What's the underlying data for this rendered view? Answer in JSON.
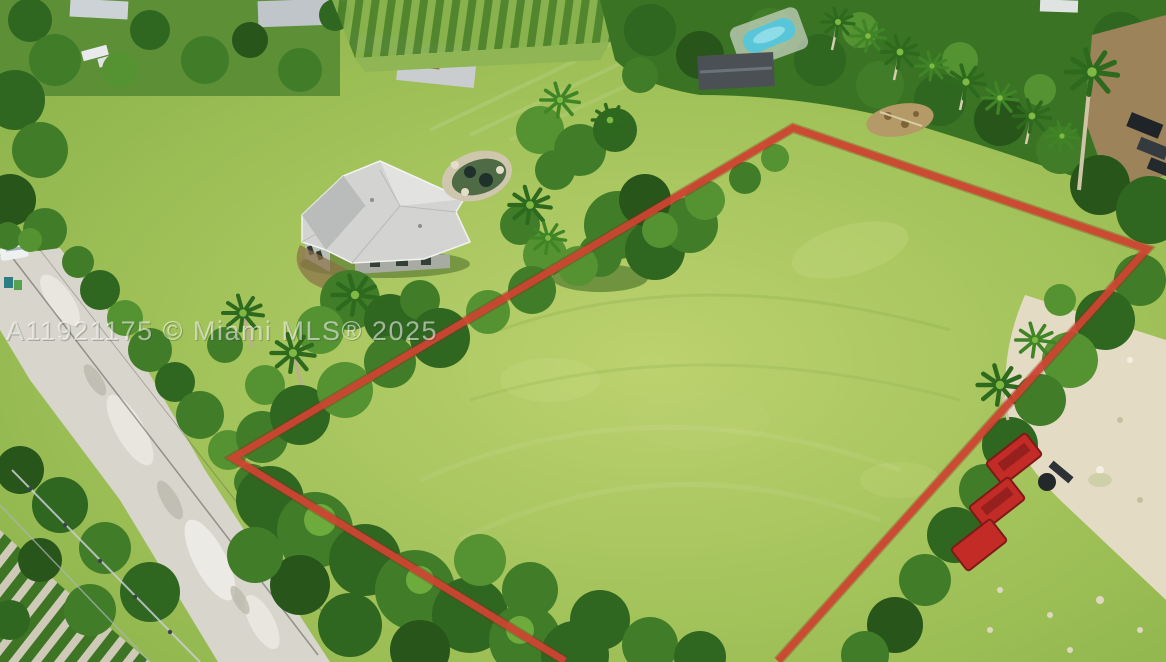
{
  "image": {
    "kind": "aerial-drone-photo",
    "description": "Aerial view of a vacant grass lot outlined in red beside a single-family home with gray hip roof, bordered by a road, palm trees, farm rows, a pool, red dumpsters and a sandy drive",
    "width_px": 1166,
    "height_px": 662
  },
  "watermark": {
    "text": "A11921175 © Miami MLS® 2025"
  },
  "colors": {
    "boundary_red": "#cf4432",
    "boundary_red_edge": "#8e2a1c",
    "lawn_light": "#bcd26f",
    "lawn_mid": "#9dbf56",
    "lawn_dark": "#83ad46",
    "tree_dark": "#2f6620",
    "tree_mid": "#417d28",
    "tree_light": "#559231",
    "road_gray": "#d8d5cd",
    "roof_gray": "#d3d4d2",
    "pool_blue": "#59c5d8",
    "pond_water": "#4f6b46",
    "rock_rim_tan": "#cfc6ae",
    "sand_tan": "#e4dbc4",
    "dumpster_red": "#c32b27",
    "shed_dark": "#4b5054",
    "dirt_brown": "#9c835a",
    "watermark_white": "#ffffff"
  }
}
